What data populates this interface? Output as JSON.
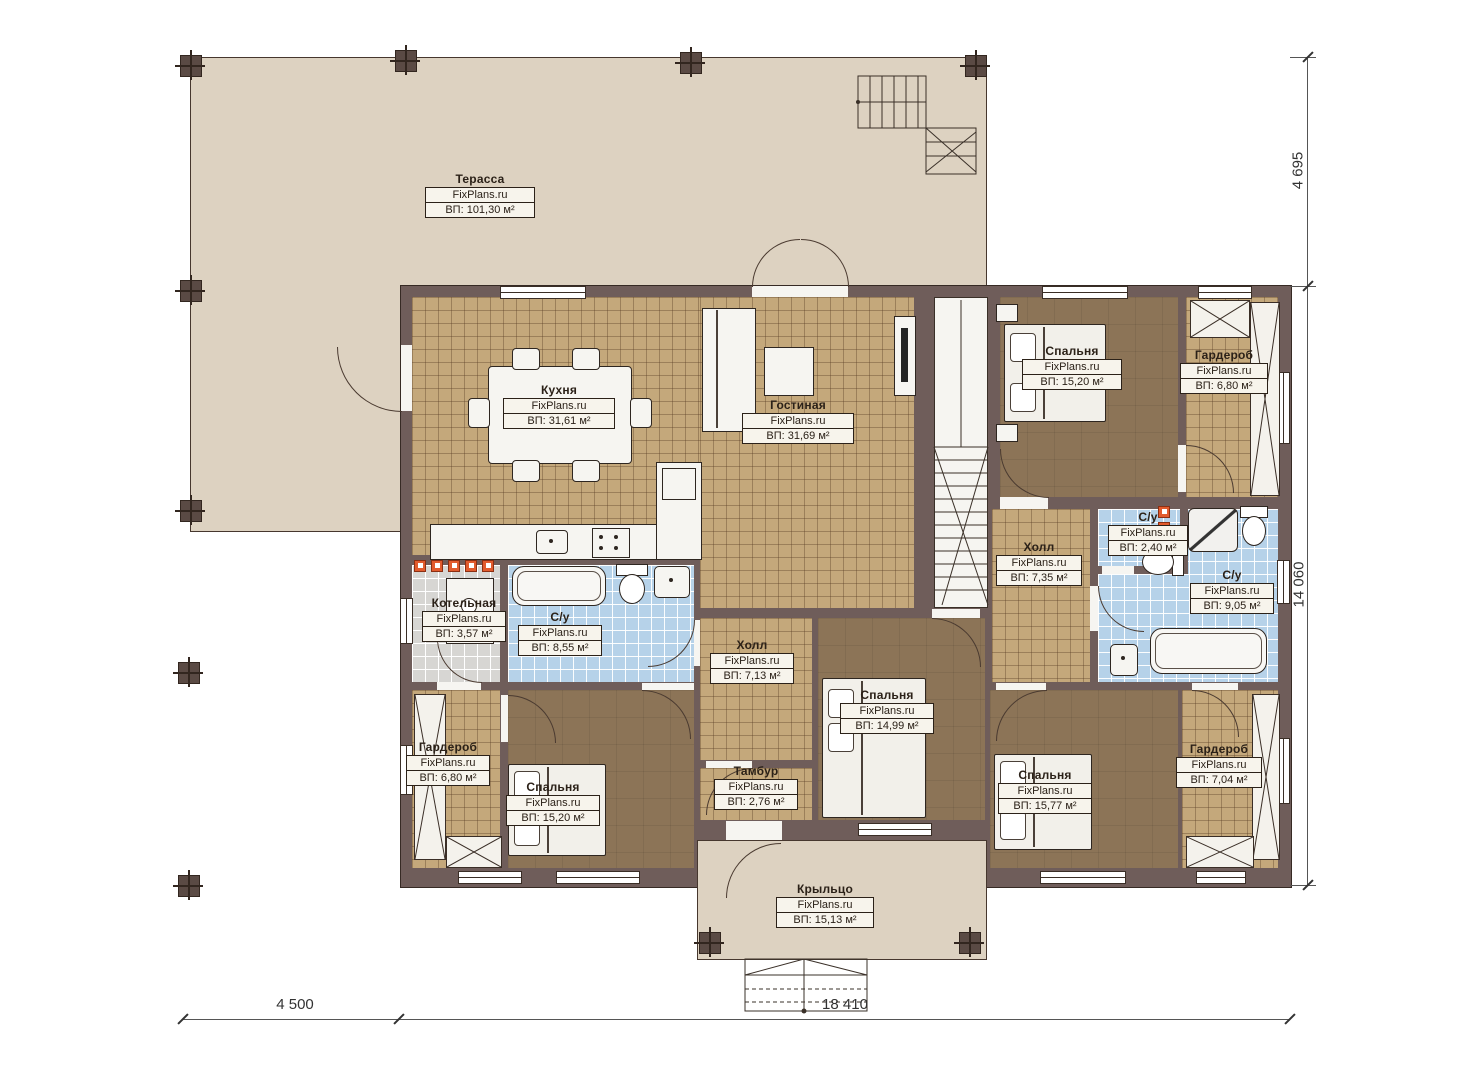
{
  "meta": {
    "brand": "FixPlans.ru",
    "plan_type": "floor-plan"
  },
  "rooms": [
    {
      "key": "terrace",
      "name": "Терасса",
      "area": "ВП: 101,30 м²"
    },
    {
      "key": "kitchen",
      "name": "Кухня",
      "area": "ВП: 31,61 м²"
    },
    {
      "key": "living-room",
      "name": "Гостиная",
      "area": "ВП: 31,69 м²"
    },
    {
      "key": "bedroom-top-right",
      "name": "Спальня",
      "area": "ВП: 15,20 м²"
    },
    {
      "key": "wardrobe-top-right",
      "name": "Гардероб",
      "area": "ВП: 6,80 м²"
    },
    {
      "key": "hall-right",
      "name": "Холл",
      "area": "ВП: 7,35 м²"
    },
    {
      "key": "wc-small",
      "name": "С/у",
      "area": "ВП: 2,40 м²"
    },
    {
      "key": "wc-right",
      "name": "С/у",
      "area": "ВП: 9,05 м²"
    },
    {
      "key": "boiler-room",
      "name": "Котельная",
      "area": "ВП: 3,57 м²"
    },
    {
      "key": "wc-left",
      "name": "С/у",
      "area": "ВП: 8,55 м²"
    },
    {
      "key": "hall-center",
      "name": "Холл",
      "area": "ВП: 7,13 м²"
    },
    {
      "key": "bedroom-center",
      "name": "Спальня",
      "area": "ВП: 14,99 м²"
    },
    {
      "key": "wardrobe-bottom-left",
      "name": "Гардероб",
      "area": "ВП: 6,80 м²"
    },
    {
      "key": "bedroom-bottom-left",
      "name": "Спальня",
      "area": "ВП: 15,20 м²"
    },
    {
      "key": "tambour",
      "name": "Тамбур",
      "area": "ВП: 2,76 м²"
    },
    {
      "key": "bedroom-bottom-right",
      "name": "Спальня",
      "area": "ВП: 15,77 м²"
    },
    {
      "key": "wardrobe-bottom-right",
      "name": "Гардероб",
      "area": "ВП: 7,04 м²"
    },
    {
      "key": "porch",
      "name": "Крыльцо",
      "area": "ВП: 15,13 м²"
    }
  ],
  "dimensions": {
    "right_upper": "4 695",
    "right_lower": "14 060",
    "bottom_left": "4 500",
    "bottom_right": "18 410"
  },
  "colors": {
    "wall": "#6f5d5a",
    "terrace_floor": "#ddd2c1",
    "tile_floor": "#c4a87b",
    "bedroom_floor": "#8c7457",
    "bath_floor": "#b6d2e9",
    "boiler_floor": "#d7d6d3",
    "accent_orange": "#e25b2d"
  }
}
